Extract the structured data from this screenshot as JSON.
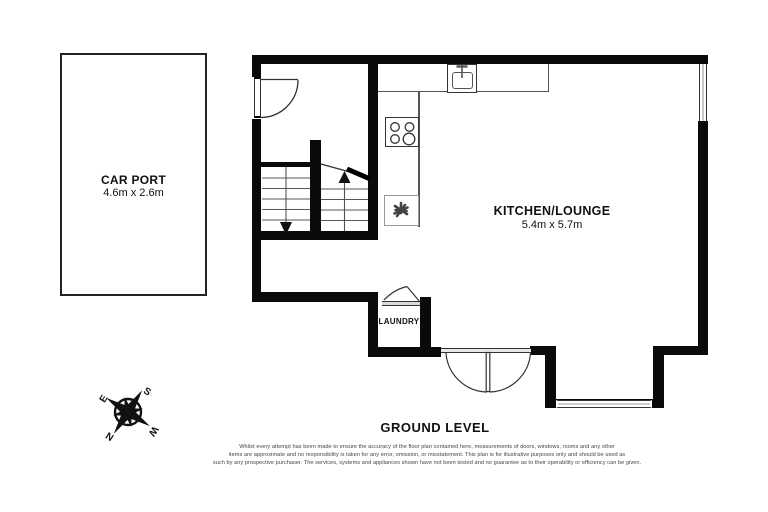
{
  "title": "GROUND LEVEL",
  "carport": {
    "name": "CAR PORT",
    "dims": "4.6m x 2.6m"
  },
  "kitchen": {
    "name": "KITCHEN/LOUNGE",
    "dims": "5.4m x 5.7m"
  },
  "laundry": {
    "name": "LAUNDRY"
  },
  "compass": {
    "n": "N",
    "e": "E",
    "s": "S",
    "w": "W"
  },
  "disclaimer": {
    "lines": [
      "Whilst every attempt has been made to ensure the accuracy of the floor plan contained here, measurements of doors, windows, rooms and any other",
      "items are approximate and no responsibility is taken for any error, omission, or misstatement. This plan is for illustrative purposes only and should be used as",
      "such by any prospective purchaser. The services, systems and appliances shown have not been tested and no guarantee as to their operability or efficiency can be given."
    ]
  },
  "icons": {
    "sink": "sink-icon",
    "stove": "stove-burners-icon",
    "fan": "fan-icon",
    "compass_rose": "compass-rose-icon"
  },
  "colors": {
    "wall": "#0a0a0a",
    "line": "#333333",
    "counter": "#555555",
    "background": "#ffffff"
  }
}
